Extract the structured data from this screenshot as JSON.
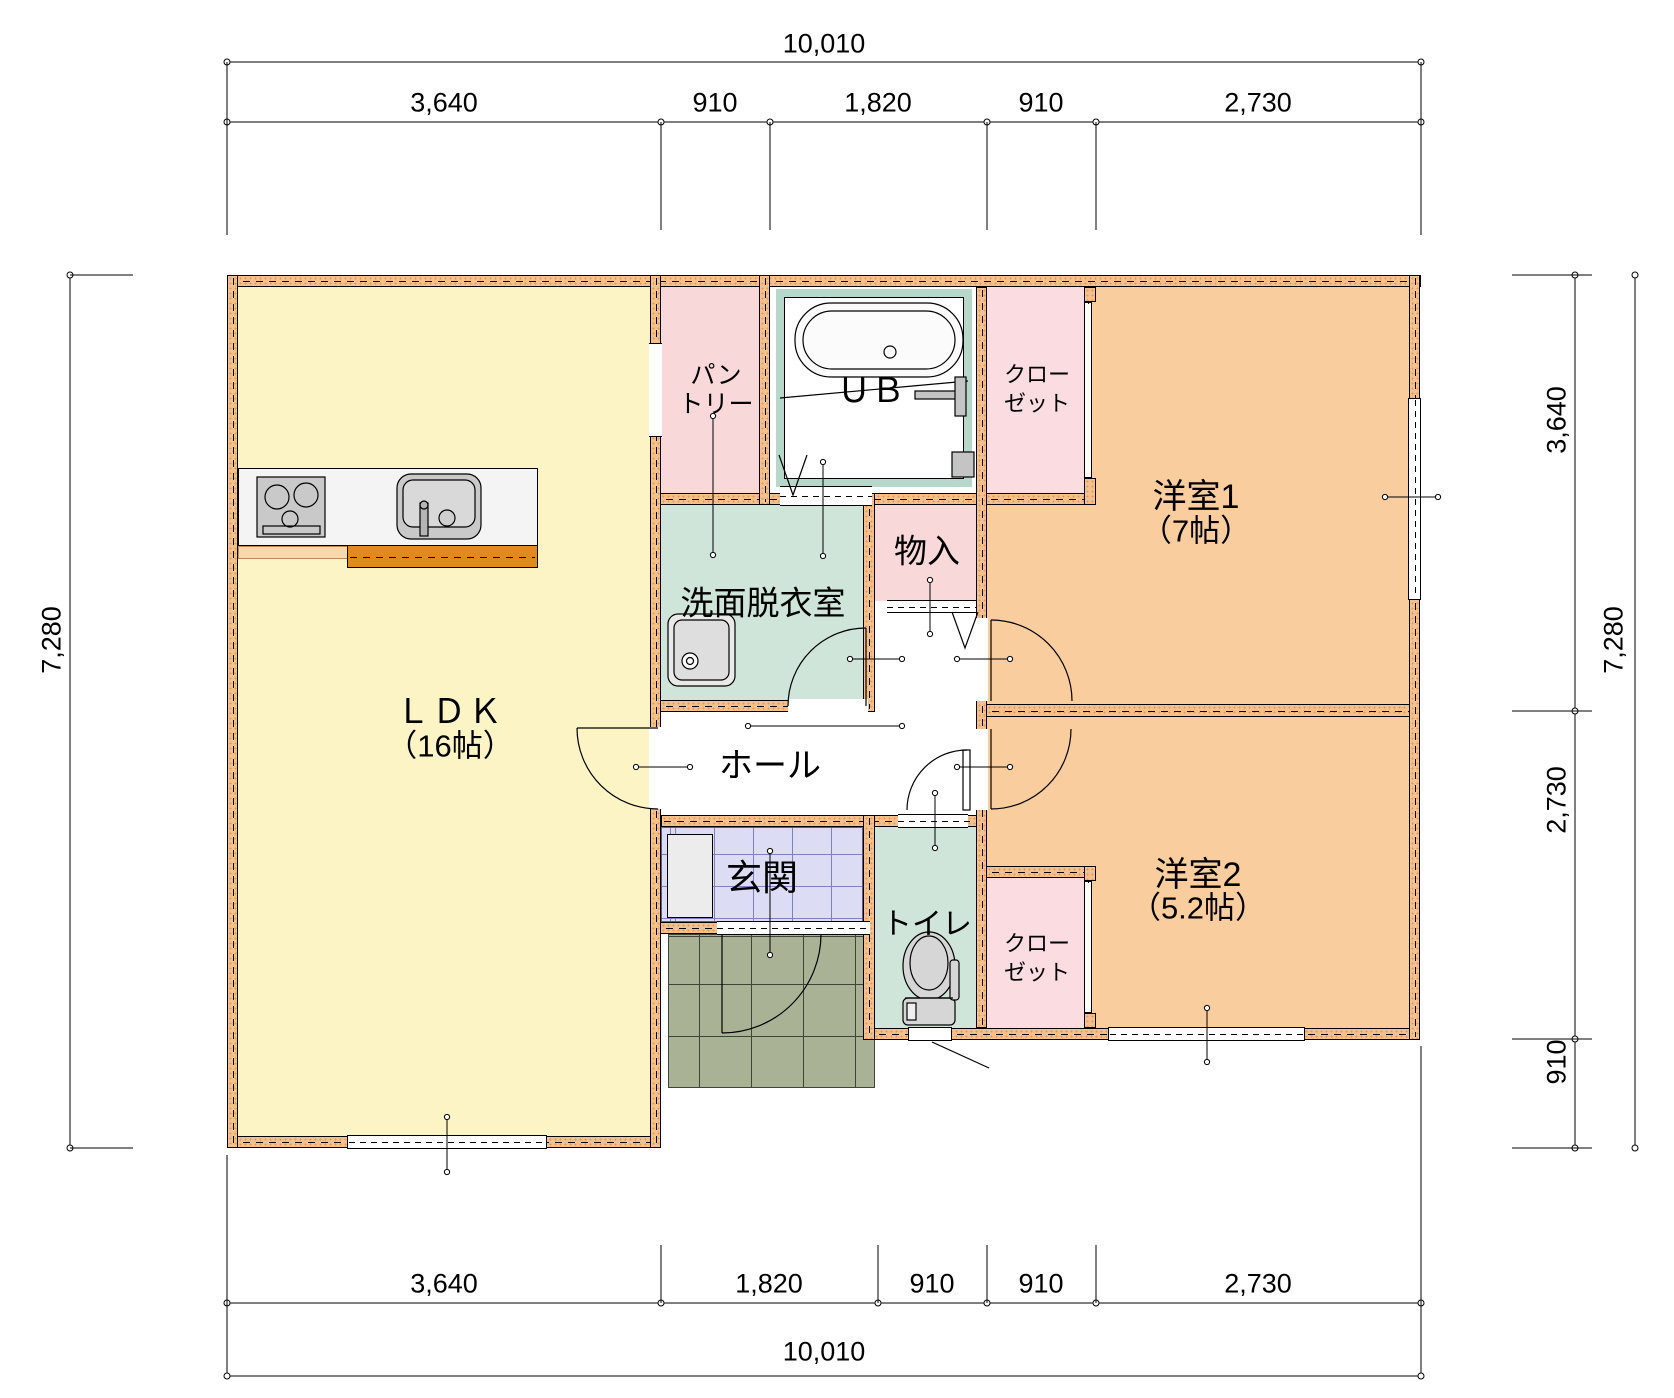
{
  "plan_title": "1F floor plan",
  "rooms": {
    "ldk": {
      "label": "ＬＤＫ",
      "size": "（16帖）"
    },
    "western1": {
      "label": "洋室1",
      "size": "（7帖）"
    },
    "western2": {
      "label": "洋室2",
      "size": "（5.2帖）"
    },
    "washroom": {
      "label": "洗面脱衣室"
    },
    "bath": {
      "label": "ＵＢ"
    },
    "pantry": {
      "line1": "パン",
      "line2": "トリー"
    },
    "closet1": {
      "line1": "クロー",
      "line2": "ゼット"
    },
    "closet2": {
      "line1": "クロー",
      "line2": "ゼット"
    },
    "storage": {
      "label": "物入"
    },
    "hall": {
      "label": "ホール"
    },
    "entrance": {
      "label": "玄関"
    },
    "toilet": {
      "label": "トイレ"
    }
  },
  "dimensions": {
    "top": {
      "total": "10,010",
      "segments": [
        "3,640",
        "910",
        "1,820",
        "910",
        "2,730"
      ]
    },
    "bottom": {
      "total": "10,010",
      "segments": [
        "3,640",
        "1,820",
        "910",
        "910",
        "2,730"
      ]
    },
    "left": {
      "total": "7,280"
    },
    "right": {
      "total": "7,280",
      "segments": [
        "3,640",
        "2,730",
        "910"
      ]
    }
  },
  "colors": {
    "wall": "#f4c08d",
    "ldk_floor": "#fdf4c6",
    "western_floor": "#f9cd9e",
    "pink_floor": "#f9d8da",
    "closet_floor": "#fbdce0",
    "wet_floor": "#cfe5da",
    "ub_frame": "#b7d7ca",
    "entrance_tile": "#dcdcf4",
    "porch_tile": "#a9b295",
    "counter_bar": "#e0891e"
  }
}
